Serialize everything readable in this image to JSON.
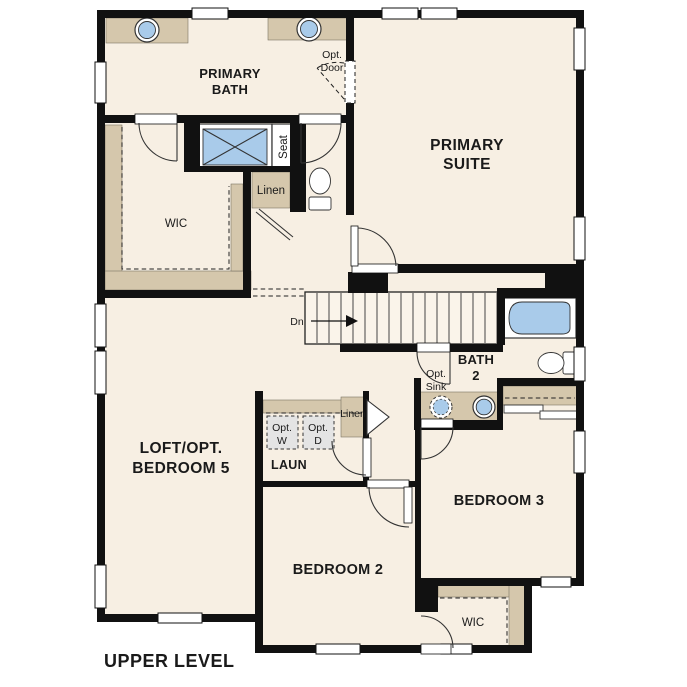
{
  "plan": {
    "title": "UPPER LEVEL"
  },
  "labels": {
    "primary_bath_line1": "PRIMARY",
    "primary_bath_line2": "BATH",
    "opt_door_line1": "Opt.",
    "opt_door_line2": "Door",
    "primary_suite_line1": "PRIMARY",
    "primary_suite_line2": "SUITE",
    "seat": "Seat",
    "linen_primary": "Linen",
    "wic_primary": "WIC",
    "stairs_down": "Dn",
    "bath2_line1": "BATH",
    "bath2_line2": "2",
    "opt_sink_line1": "Opt.",
    "opt_sink_line2": "Sink",
    "loft_line1": "LOFT/OPT.",
    "loft_line2": "BEDROOM 5",
    "laundry": "LAUN",
    "opt_washer_line1": "Opt.",
    "opt_washer_line2": "W",
    "opt_dryer_line1": "Opt.",
    "opt_dryer_line2": "D",
    "linen_laundry": "Linen",
    "bedroom2": "BEDROOM 2",
    "bedroom3": "BEDROOM 3",
    "wic_bedroom2": "WIC"
  },
  "colors": {
    "wall": "#111111",
    "floor": "#f7efe3",
    "builtin": "#d5c7ac",
    "fixture": "#a9cbea",
    "optional_fill": "#e4e4e4",
    "line": "#333333",
    "text": "#1a1a1a",
    "background": "#ffffff"
  }
}
